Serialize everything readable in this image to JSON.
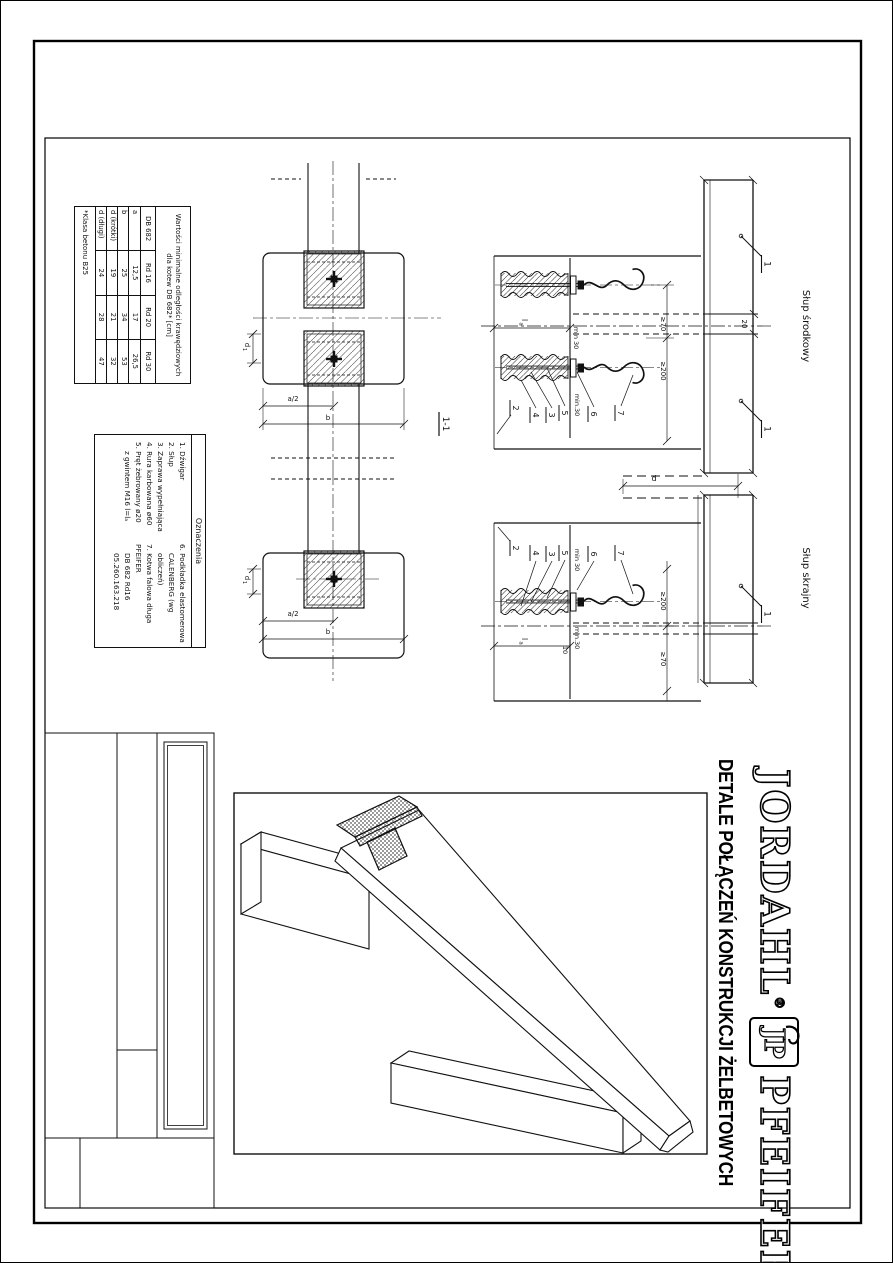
{
  "sheet": {
    "title": "DETALE POŁĄCZEŃ KONSTRUKCJI ŻELBETOWYCH"
  },
  "brand": {
    "jordahl": "JORDAHL",
    "registered": "®",
    "jp": "JP",
    "pfeifer": "PFEIFER"
  },
  "table": {
    "title": "Wartości minimalne odległości krawędziowych dla kotew DB 682* [cm]",
    "corner": "DB 682",
    "cols": [
      "Rd 16",
      "Rd 20",
      "Rd 30"
    ],
    "rows": [
      {
        "label": "a",
        "values": [
          "12,5",
          "17",
          "26,5"
        ]
      },
      {
        "label": "b",
        "values": [
          "25",
          "34",
          "53"
        ]
      },
      {
        "label": "d (krótki)",
        "values": [
          "19",
          "21",
          "32"
        ]
      },
      {
        "label": "d (długi)",
        "values": [
          "24",
          "28",
          "47"
        ]
      }
    ],
    "footnote": "*Klasa betonu B25"
  },
  "legend": {
    "title": "Oznaczenia",
    "left": [
      "1. Dźwigar",
      "2. Słup",
      "3. Zaprawa wypełniająca",
      "4. Rura karbowana ø60",
      "5. Pręt żebrowany ø20",
      "z gwintem M16 l=lₐ"
    ],
    "right": [
      "6. Podkładka elastomerowa",
      "CALENBERG (wg obliczeń)",
      "7. Kotwa falowa długa PFEIFER",
      "DB 682 Rd16",
      "05.260.163.218"
    ]
  },
  "labels": {
    "middle_column": "Słup środkowy",
    "edge_column": "Słup skrajny",
    "section_marker": "1",
    "section_title": "1-1"
  },
  "dims": {
    "joint_gap": "20",
    "ge70": "≥70",
    "ge200": "≥200",
    "min30": "min 30",
    "min30_dot": "min.30",
    "ten": "10",
    "d": "d",
    "a_half": "a/2",
    "b": "b",
    "la_main": "l",
    "la_sub": "a",
    "d1_main": "d",
    "d1_sub": "1"
  },
  "callouts": {
    "n2": "2",
    "n3": "3",
    "n4": "4",
    "n5": "5",
    "n6": "6",
    "n7": "7"
  }
}
